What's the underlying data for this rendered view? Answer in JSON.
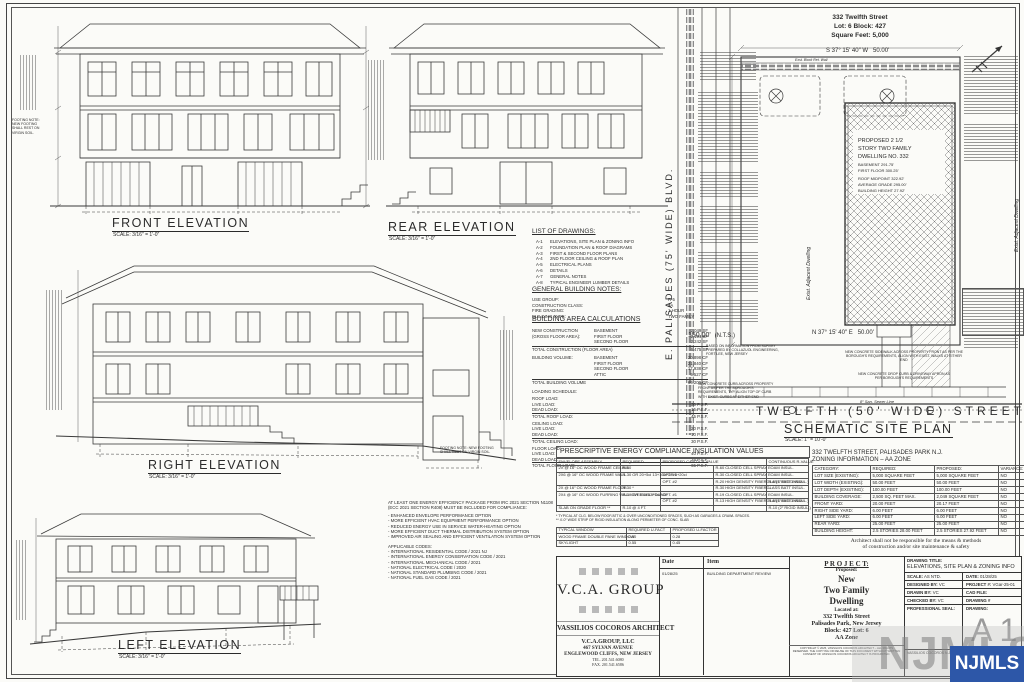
{
  "colors": {
    "ink": "#2b2b2b",
    "paper": "#fbfbf8",
    "njmls_blue": "#2d57a8",
    "watermark_gray": "#8e8e8e"
  },
  "elevations": {
    "front": {
      "title": "FRONT ELEVATION",
      "scale": "SCALE: 3/16″ = 1'-0″"
    },
    "rear": {
      "title": "REAR ELEVATION",
      "scale": "SCALE: 3/16″ = 1'-0″"
    },
    "right": {
      "title": "RIGHT ELEVATION",
      "scale": "SCALE: 3/16″ = 1'-0″"
    },
    "left": {
      "title": "LEFT ELEVATION",
      "scale": "SCALE: 3/16″ = 1'-0″"
    }
  },
  "footing_note": "FOOTING NOTE: NEW FOOTING SHALL REST ON VIRGIN SOIL.",
  "list_of_drawings": {
    "title": "LIST OF DRAWINGS:",
    "items": [
      {
        "code": "A-1",
        "label": "ELEVATIONS, SITE PLAN & ZONING INFO"
      },
      {
        "code": "A-2",
        "label": "FOUNDATION PLAN & ROOF DIAGRAMS"
      },
      {
        "code": "A-3",
        "label": "FIRST & SECOND FLOOR PLANS"
      },
      {
        "code": "A-4",
        "label": "2ND FLOOR CEILING & ROOF PLAN"
      },
      {
        "code": "A-5",
        "label": "ELECTRICAL PLANS"
      },
      {
        "code": "A-6",
        "label": "DETAILS"
      },
      {
        "code": "A-7",
        "label": "GENERAL NOTES"
      },
      {
        "code": "A-8",
        "label": "TYPICAL ENGINEER LUMBER DETAILS"
      }
    ]
  },
  "general_building_notes": {
    "title": "GENERAL BUILDING NOTES:",
    "rows": [
      {
        "label": "USE GROUP:",
        "value": "R-5"
      },
      {
        "label": "CONSTRUCTION CLASS:",
        "value": "5A"
      },
      {
        "label": "FIRE GRADING:",
        "value": "1 HOUR"
      },
      {
        "label": "BUILDING TYPE:",
        "value": "TWO FAMILY"
      }
    ]
  },
  "building_area": {
    "title": "BUILDING AREA CALCULATIONS",
    "construction_label1": "NEW CONSTRUCTION",
    "construction_label2": "(GROSS FLOOR AREA):",
    "construction_rows": [
      [
        "BASEMENT",
        "2,049 SF"
      ],
      [
        "FIRST FLOOR",
        "2,194 SF"
      ],
      [
        "SECOND FLOOR",
        "2,242 SF"
      ]
    ],
    "construction_total": [
      "TOTAL CONSTRUCTION (FLOOR AREA)",
      "6,475 SF"
    ],
    "volume_label": "BUILDING VOLUME:",
    "volume_rows": [
      [
        "BASEMENT",
        "20,898 CF"
      ],
      [
        "FIRST FLOOR",
        "21,840 CF"
      ],
      [
        "SECOND FLOOR",
        "17,938 CF"
      ],
      [
        "ATTIC",
        "5,527 CF"
      ]
    ],
    "volume_total": [
      "TOTAL BUILDING VOLUME",
      "66,209 CF"
    ],
    "loading_title": "LOADING SCHEDULE:",
    "roof_label": "ROOF LOAD:",
    "roof_rows": [
      [
        "LIVE LOAD:",
        "30 P.S.F."
      ],
      [
        "DEAD LOAD:",
        "15 P.S.F."
      ]
    ],
    "roof_total": [
      "TOTAL ROOF LOAD:",
      "45 P.S.F."
    ],
    "ceiling_label": "CEILING LOAD:",
    "ceiling_rows": [
      [
        "LIVE LOAD:",
        "20 P.S.F."
      ],
      [
        "DEAD LOAD:",
        "10 P.S.F."
      ]
    ],
    "ceiling_total": [
      "TOTAL CEILING LOAD:",
      "30 P.S.F."
    ],
    "floor_label": "FLOOR LOAD:",
    "floor_rows": [
      [
        "LIVE LOAD:",
        "40 P.S.F."
      ],
      [
        "DEAD LOAD:",
        "25 P.S.F."
      ]
    ],
    "floor_total": [
      "TOTAL FLOOR LOAD:",
      "65 P.S.F."
    ]
  },
  "energy_note": {
    "heading1": "AT LEAST ONE ENERGY EFFICIENCY PACKAGE FROM IRC 2021 SECTION N1108",
    "heading2": "(ECC 2021 SECTION R408) MUST BE INCLUDED FOR COMPLIANCE:",
    "options": [
      "- ENHANCED ENVELOPE PERFORMANCE OPTION",
      "- MORE EFFICIENT HVAC EQUIPMENT PERFORMANCE OPTION",
      "- REDUCED ENERGY USE IN SERVICE WATER-HEATING OPTION",
      "- MORE EFFICIENT DUCT THERMAL DISTRIBUTION SYSTEM OPTION",
      "- IMPROVED AIR SEALING AND EFFICIENT VENTILATION SYSTEM OPTION"
    ],
    "codes_title": "APPLICABLE CODES:",
    "codes": [
      "- INTERNATIONAL RESIDENTIAL CODE / 2021 NJ",
      "- INTERNATIONAL ENERGY CONSERVATION CODE / 2021",
      "- INTERNATIONAL MECHANICAL CODE / 2021",
      "- NATIONAL ELECTRICAL CODE / 2020",
      "- NATIONAL STANDARD PLUMBING CODE / 2021",
      "- NATIONAL FUEL GAS CODE / 2021"
    ]
  },
  "insulation_table": {
    "title": "PRESCRIPTIVE ENERGY COMPLIANCE INSULATION VALUES",
    "h_assembly": "ENVELOPE ASSEMBLY",
    "h_required": "REQUIRED",
    "h_proposed": "PROPOSED  CAVITY R-VALUE",
    "h_continuous": "CONTINUOUS R-VALUE",
    "rows": [
      {
        "assembly": "2X @ 16″ OC WOOD FRAME CEILING",
        "required": "R-60",
        "opt": "",
        "cavity": "R-60 CLOSED CELL SPRAY FOAM INSUL.",
        "continuous": "–"
      },
      {
        "assembly": "2X6 @ 16″ OC WOOD FRAME WALL",
        "required": "R-30 OR 20+5ci 13+10ci OR 0+20ci",
        "opt": "OPT. #1",
        "cavity": "R-30 CLOSED CELL SPRAY FOAM INSUL.",
        "continuous": "–"
      },
      {
        "assembly": "",
        "required": "",
        "opt": "OPT. #2",
        "cavity": "R-20 HIGH DENSITY FIBERGLASS BATT INSUL.",
        "continuous": "R-5 (1″ RIGID INSUL.)"
      },
      {
        "assembly": "2X @ 16″ OC WOOD FRAME FLOOR",
        "required": "R-30 *",
        "opt": "",
        "cavity": "R-30 HIGH DENSITY FIBERGLASS BATT INSUL.",
        "continuous": "–"
      },
      {
        "assembly": "2X4 @ 16″ OC WOOD FURRING WALL OVER DBL FOUND.",
        "required": "R-19 OR 15ci 13+5ci",
        "opt": "OPT. #1",
        "cavity": "R-19 CLOSED CELL SPRAY FOAM INSUL.",
        "continuous": "–"
      },
      {
        "assembly": "",
        "required": "",
        "opt": "OPT. #2",
        "cavity": "R-13 HIGH DENSITY FIBERGLASS BATT INSUL.",
        "continuous": "R-5 (1″ RIGID INSUL.)"
      },
      {
        "assembly": "SLAB ON GRADE FLOOR **",
        "required": "R-10 @ 4 FT.",
        "opt": "",
        "cavity": "",
        "continuous": "R-10 (2″ RIGID INSUL.)"
      }
    ],
    "footnote1": "* TYPICAL AT CLG. BELOW ROOF/ATTIC & OVER UNCONDITIONED SPACES, SUCH AS GARAGES & CRAWL SPACES.",
    "footnote2": "** 4'-0″ WIDE STRIP OF RIGID INSULATION ALONG PERIMETER OF CONC. SLAB"
  },
  "window_table": {
    "headers": [
      "TYPICAL WINDOW",
      "REQUIRED U-FACT",
      "PROPOSED U-FACTOR"
    ],
    "rows": [
      [
        "WOOD FRAME DOUBLE PANE WINDOW",
        "0.30",
        "0.28"
      ],
      [
        "SKYLIGHT",
        "0.55",
        "0.45"
      ]
    ]
  },
  "zoning": {
    "title1": "332 TWELFTH STREET, PALISADES PARK N.J.",
    "title2": "ZONING INFORMATION – AA ZONE",
    "headers": [
      "CATEGORY:",
      "REQUIRED:",
      "PROPOSED:",
      "VARIANCE:"
    ],
    "rows": [
      [
        "LOT SIZE (EXISTING):",
        "5,000 SQUARE FEET",
        "5,000 SQUARE FEET",
        "NO"
      ],
      [
        "LOT WIDTH (EXISTING):",
        "50.00 FEET",
        "50.00 FEET",
        "NO"
      ],
      [
        "LOT DEPTH (EXISTING):",
        "100.00 FEET",
        "100.00 FEET",
        "NO"
      ],
      [
        "BUILDING COVERAGE:",
        "2,500 SQ. FEET MAX.",
        "2,049 SQUARE FEET",
        "NO"
      ],
      [
        "FRONT YARD:",
        "20.00 FEET",
        "20.17 FEET",
        "NO"
      ],
      [
        "RIGHT SIDE YARD:",
        "6.00 FEET",
        "6.00 FEET",
        "NO"
      ],
      [
        "LEFT SIDE YARD:",
        "6.00 FEET",
        "6.00 FEET",
        "NO"
      ],
      [
        "REAR YARD:",
        "25.00 FEET",
        "25.00 FEET",
        "NO"
      ],
      [
        "BUILDING HEIGHT:",
        "2.5 STORIES 28.00 FEET",
        "2.5 STORIES 27.92 FEET",
        "NO"
      ]
    ],
    "disclaimer1": "Architect shall not be responsible for the means & methods",
    "disclaimer2": "of construction and/or site maintenance & safety"
  },
  "site_plan": {
    "header_line1": "332 Twelfth Street",
    "header_line2": "Lot: 6 Block: 427",
    "header_line3": "Square Feet: 5,000",
    "bearing_top": "S 37° 15' 40″ W",
    "dist_top": "50.00'",
    "ret_wall": "Exst. Block Ret. Wall",
    "bearing_bottom": "N 37° 15' 40″ E",
    "dist_bottom": "50.00'",
    "dim_left": "150.00'",
    "nts": "(N.T.S.)",
    "survey_note": "BASED ON INFORMATION FROM SURVEY PREPARED BY COLLAZUOL ENGINEERING, FORT LEE, NEW JERSEY",
    "street": "TWELFTH   (50' WIDE)   STREET",
    "blvd": "E.  PALISADES  (75' WIDE)  BLVD.",
    "dwelling1": "PROPOSED 2 1/2",
    "dwelling2": "STORY TWO FAMILY",
    "dwelling3": "DWELLING NO. 332",
    "basement": "BASEMENT  291.75'",
    "first_floor": "FIRST FLOOR  300.25'",
    "roof_midpoint": "ROOF MIDPOINT  322.92'",
    "avg_grade": "AVERAGE GRADE  295.00'",
    "bldg_height": "BUILDING HEIGHT  27.92'",
    "adjacent": "Exist. Adjacent Dwelling",
    "title": "SCHEMATIC SITE PLAN",
    "scale": "SCALE: 1″ = 10'-0″",
    "sidewalk_note": "NEW CONCRETE SIDEWALK ACROSS PROPERTY FRONT AS PER THE BOROUGH'S REQUIREMENTS, ALIGN WITH EXIST. WALKS AT EITHER END",
    "apron_note": "NEW CONCRETE DROP CURB & DRIVEWAY APRON AS PER BOROUGH'S REQUIREMENTS",
    "curb_note": "NEW CONCRETE CURB ACROSS PROPERTY FRONT AS PER THE BOROUGH'S REQUIREMENTS, TYP. ALIGN TOP OF CURB WITH EXIST. CURBS AT EITHER END",
    "sewer_note": "8″ San. Sewer Line"
  },
  "title_block": {
    "firm_logo": "V.C.A.  GROUP",
    "architect": "VASSILIOS COCOROS ARCHITECT",
    "firm_llc": "V.C.A.GROUP, LLC",
    "address1": "467 SYLVAN AVENUE",
    "address2": "ENGLEWOOD CLIFFS, NEW JERSEY",
    "tel": "TEL. 201.541.6080",
    "fax": "FAX. 201.541.6586",
    "rev_date_header": "Date",
    "rev_item_header": "Item",
    "rev_date": "01/28/25",
    "rev_item": "BUILDING DEPARTMENT REVIEW",
    "project_heading": "P R O J E C T:",
    "proposed_label": "Proposed:",
    "project_name1": "New",
    "project_name2": "Two  Family",
    "project_name3": "Dwelling",
    "located_label": "Located at:",
    "addr1": "332 Twelfth Street",
    "addr2": "Palisades Park, New Jersey",
    "addr3": "Block: 427 Lot: 6",
    "addr4": "AA Zone",
    "copyright": "COPYRIGHT © 2025, VASSILIOS COCOROS ARCHITECT – ALL RIGHTS RESERVED. THE COPYING OR REUSE OF THIS DOCUMENT WITHOUT WRITTEN CONSENT OF VASSILIOS COCOROS ARCHITECT IS PROHIBITED.",
    "drawing_title_label": "DRAWING TITLE:",
    "drawing_title": "ELEVATIONS, SITE PLAN & ZONING INFO",
    "scale_label": "SCALE:",
    "scale_value": "AS NTD.",
    "date_label": "DATE:",
    "date_value": "01/28/25",
    "designed_label": "DESIGNED BY:",
    "designed_value": "VC",
    "project_no_label": "PROJECT #:",
    "project_no_value": "VGar-25-01",
    "drawn_label": "DRAWN BY:",
    "drawn_value": "VC",
    "cad_label": "CAD FILE:",
    "checked_label": "CHECKED BY:",
    "checked_value": "VC",
    "drawing_no_label": "DRAWING #",
    "seal_label": "PROFESSIONAL SEAL:",
    "drawing_label": "DRAWING:",
    "sheet_no": "A 1",
    "license": "VASSILIOS COCOROS   N.J. LIC. # AI 13844"
  },
  "watermark": {
    "text": "NJMLS"
  }
}
